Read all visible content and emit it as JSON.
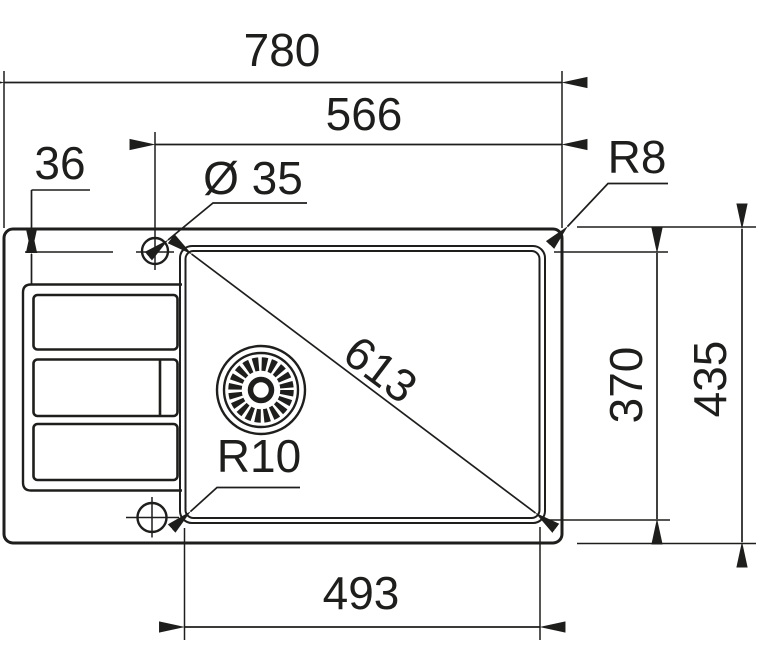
{
  "colors": {
    "ink": "#1e1e1c",
    "paper": "#ffffff"
  },
  "labels": {
    "overall_length": "780",
    "tap_center_from_right": "566",
    "tap_offset_from_edge": "36",
    "tap_hole_diameter": "Ø 35",
    "outer_corner_radius": "R8",
    "bowl_diagonal": "613",
    "bowl_width": "370",
    "overall_width": "435",
    "bowl_length": "493",
    "bowl_corner_radius": "R10"
  }
}
